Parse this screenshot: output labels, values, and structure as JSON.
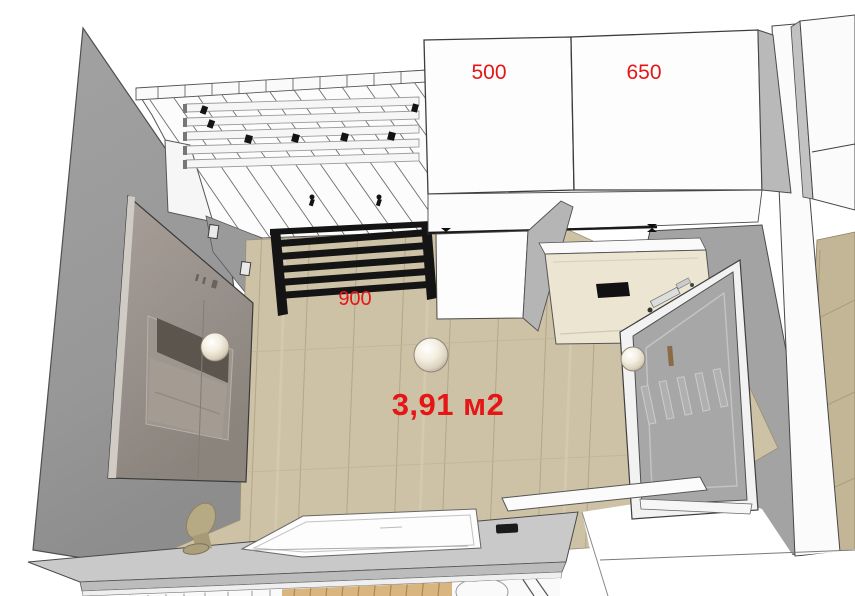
{
  "labels": {
    "cabinet_left_width": "500",
    "cabinet_right_width": "650",
    "towel_rail_width": "900",
    "floor_area": "3,91 м2"
  },
  "colors": {
    "dimension_red": "#e41616",
    "floor_wood": "#cdc2a6",
    "adjacent_floor_wood": "#c3b696",
    "wall_gray": "#9b9b9b",
    "cabinet_white": "#fdfdfd",
    "appliance_cream": "#ece5d2",
    "radiator_black": "#141414",
    "door_gray": "#a7a7a7",
    "counter_gray": "#c9c9c9",
    "mirror_taupe": "#a09790"
  }
}
